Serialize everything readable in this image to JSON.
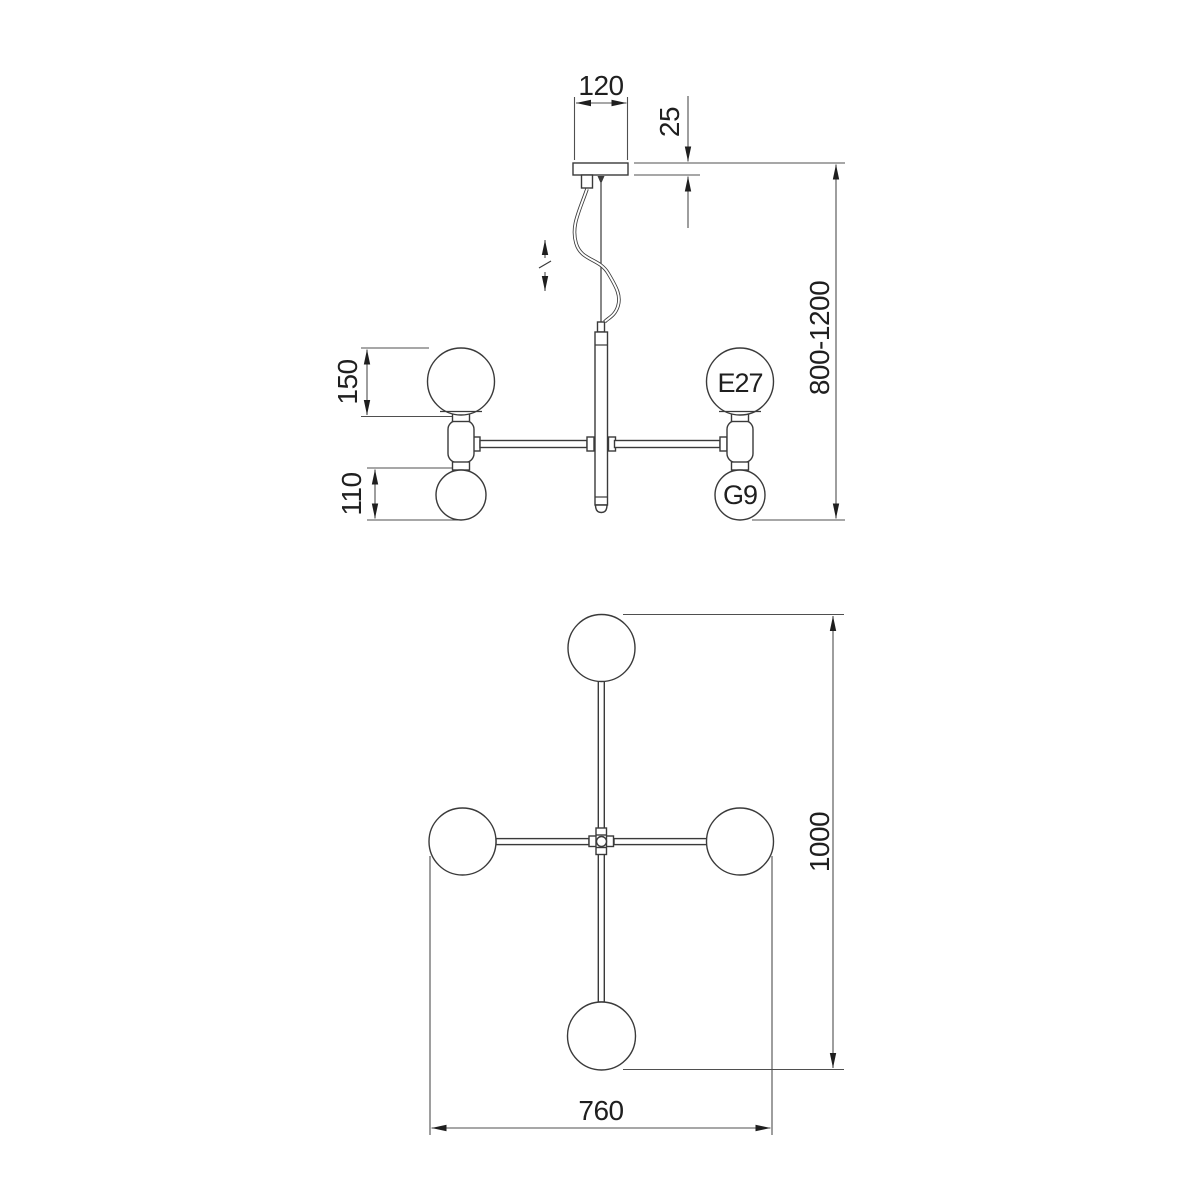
{
  "drawing": {
    "colors": {
      "background": "#ffffff",
      "line": "#3a3a3a",
      "dimension": "#4f4f4f",
      "text": "#1f1f1f"
    },
    "labels": {
      "canopy_width_mm": "120",
      "canopy_thickness_mm": "25",
      "hanging_height_range_mm": "800-1200",
      "large_globe_mm": "150",
      "small_globe_mm": "110",
      "socket_large": "E27",
      "socket_small": "G9",
      "plan_depth_mm": "1000",
      "plan_width_mm": "760"
    }
  }
}
